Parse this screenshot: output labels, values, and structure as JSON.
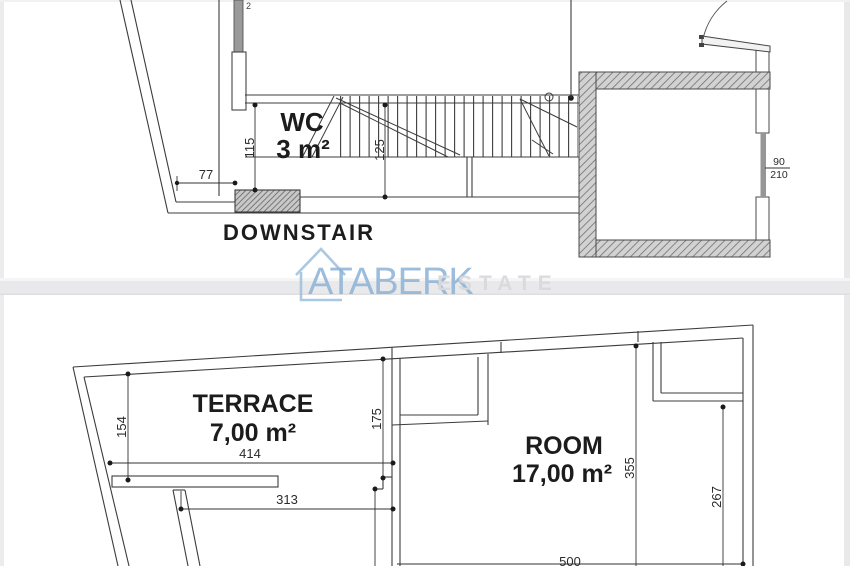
{
  "watermark": {
    "brand": "ATABERK",
    "suffix": "ESTATE",
    "accent_color": "#8cb2d6"
  },
  "upper_plan": {
    "room_label": "WC",
    "room_area": "3 m²",
    "caption": "DOWNSTAIR",
    "door_width": "90",
    "door_height": "210",
    "edge_note": "2",
    "dims": {
      "wc_height": "115",
      "stair_width": "125",
      "offset": "77"
    }
  },
  "lower_plan": {
    "terrace_label": "TERRACE",
    "terrace_area": "7,00 m²",
    "room_label": "ROOM",
    "room_area": "17,00 m²",
    "dims": {
      "left_height": "154",
      "terrace_width": "414",
      "lower_width": "313",
      "niche_height": "175",
      "room_height": "355",
      "room_right_height": "267",
      "room_width": "500"
    }
  }
}
